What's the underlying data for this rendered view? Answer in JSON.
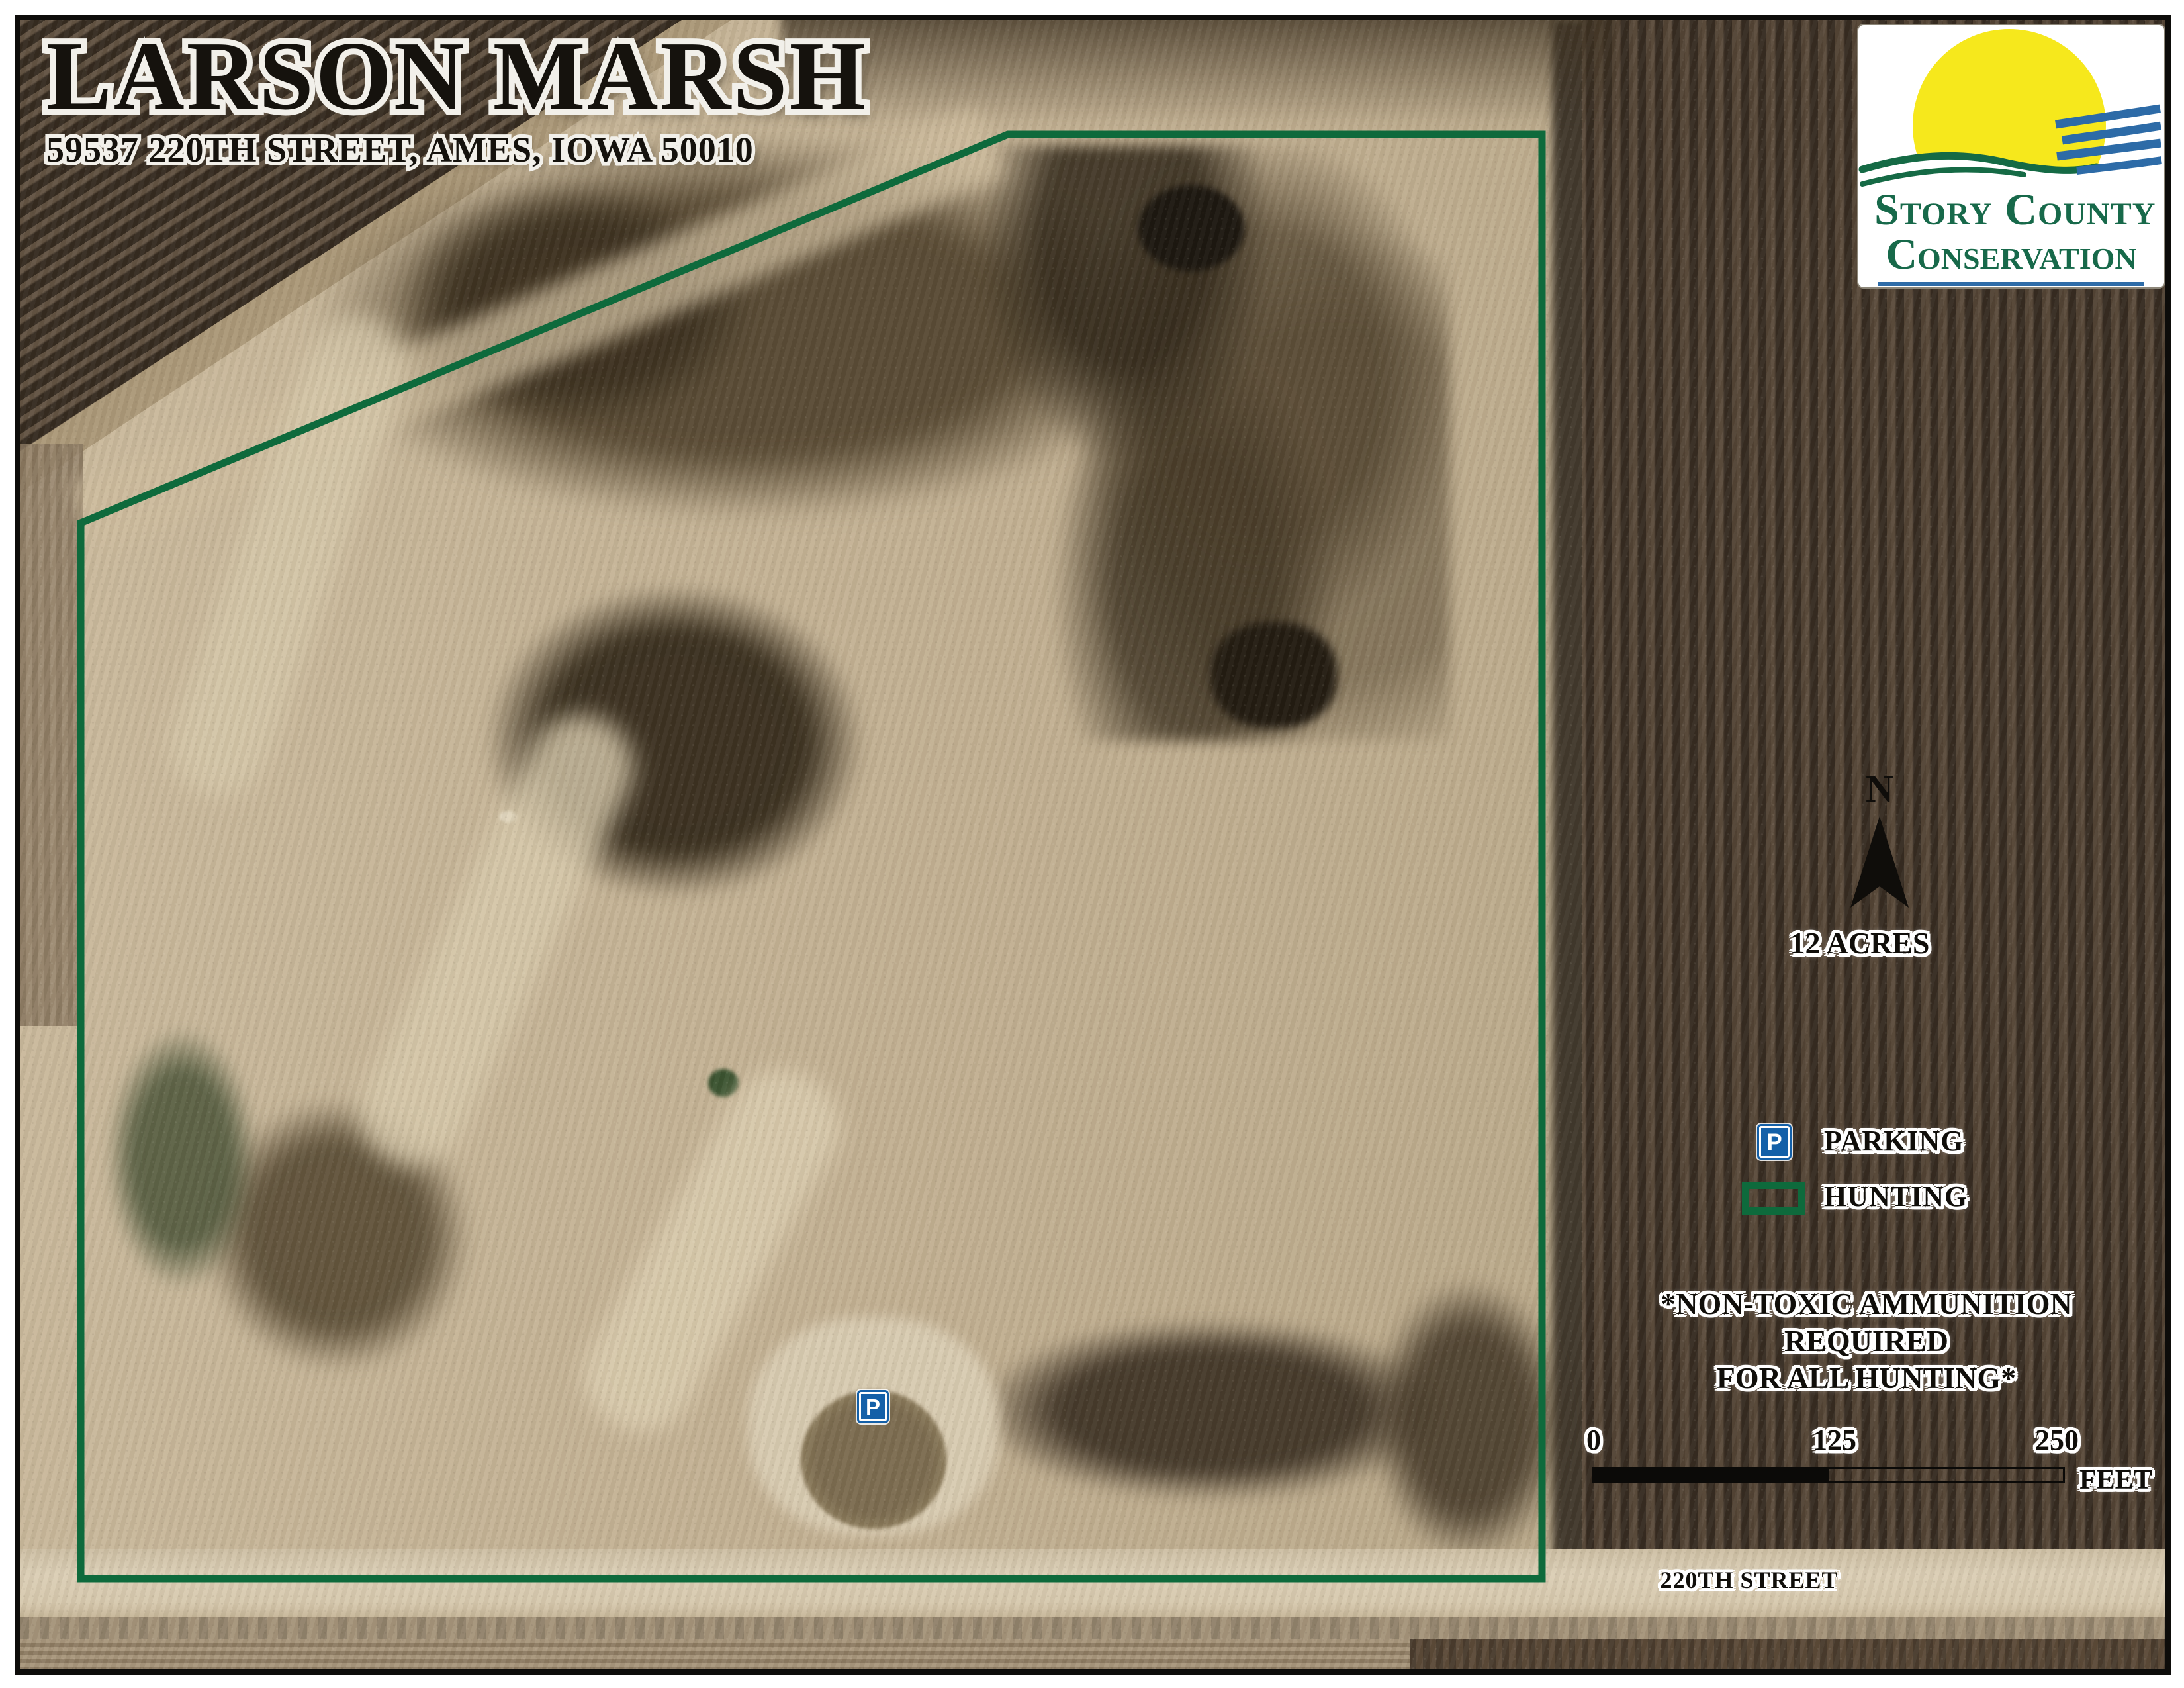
{
  "title": {
    "name": "LARSON MARSH",
    "address": "59537 220TH STREET, AMES, IOWA 50010"
  },
  "logo": {
    "line1": "Story County",
    "line2": "Conservation"
  },
  "compass": {
    "label": "N"
  },
  "area": {
    "label": "12 ACRES"
  },
  "legend": {
    "parking_symbol": "P",
    "parking_label": "PARKING",
    "hunting_label": "HUNTING"
  },
  "notice": {
    "line1": "*NON-TOXIC AMMUNITION REQUIRED",
    "line2": "FOR ALL HUNTING*"
  },
  "scale_bar": {
    "start": "0",
    "middle": "125",
    "end": "250",
    "unit": "FEET"
  },
  "street": {
    "label": "220TH STREET"
  },
  "map": {
    "parking_symbol": "P"
  },
  "colors": {
    "boundary_green": "#0e6a3c",
    "parking_blue": "#1460a8",
    "logo_sun_yellow": "#f6e81c",
    "logo_wave_blue": "#2d6ba7",
    "logo_green": "#156a45",
    "logo_text_green": "#17694a",
    "halo_white": "#ffffff",
    "ink_black": "#14120e",
    "aerial_tan": "#c2b092",
    "field_dark_brown": "#4a3b2d"
  }
}
